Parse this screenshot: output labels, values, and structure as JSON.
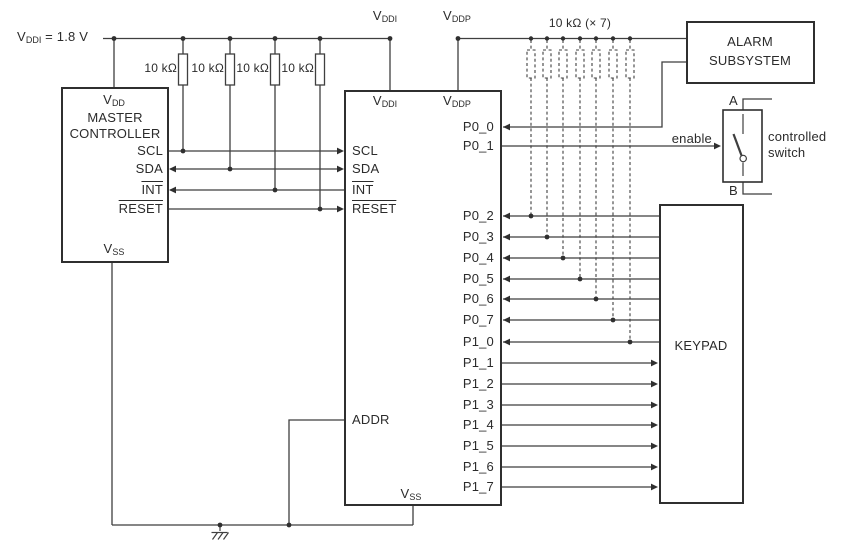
{
  "labels": {
    "supply": {
      "base": "V",
      "sub": "DDI",
      "rest": " = 1.8 V"
    },
    "vddi_rail": {
      "base": "V",
      "sub": "DDI"
    },
    "vddp_rail": {
      "base": "V",
      "sub": "DDP"
    },
    "pullup": "10 kΩ",
    "pullup_dashed": "10 kΩ (× 7)"
  },
  "master": {
    "vdd": {
      "base": "V",
      "sub": "DD"
    },
    "title1": "MASTER",
    "title2": "CONTROLLER",
    "scl": "SCL",
    "sda": "SDA",
    "int": "INT",
    "reset": "RESET",
    "vss": {
      "base": "V",
      "sub": "SS"
    }
  },
  "expander": {
    "vddi": {
      "base": "V",
      "sub": "DDI"
    },
    "vddp": {
      "base": "V",
      "sub": "DDP"
    },
    "scl": "SCL",
    "sda": "SDA",
    "int": "INT",
    "reset": "RESET",
    "addr": "ADDR",
    "vss": {
      "base": "V",
      "sub": "SS"
    },
    "port0": [
      "P0_0",
      "P0_1",
      "P0_2",
      "P0_3",
      "P0_4",
      "P0_5",
      "P0_6",
      "P0_7"
    ],
    "port1": [
      "P1_0",
      "P1_1",
      "P1_2",
      "P1_3",
      "P1_4",
      "P1_5",
      "P1_6",
      "P1_7"
    ]
  },
  "alarm": {
    "line1": "ALARM",
    "line2": "SUBSYSTEM"
  },
  "keypad": {
    "label": "KEYPAD"
  },
  "switch": {
    "terminal_a": "A",
    "terminal_b": "B",
    "enable": "enable",
    "caption1": "controlled",
    "caption2": "switch"
  }
}
